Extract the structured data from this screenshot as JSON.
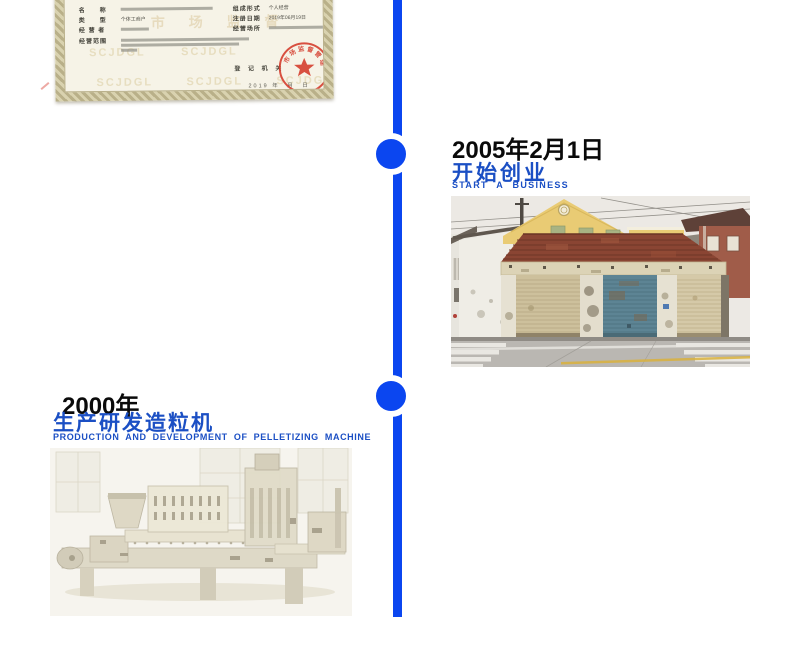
{
  "page": {
    "background": "#ffffff"
  },
  "colors": {
    "timeline_blue": "#0b46f0",
    "heading_blue": "#1b4fc4",
    "heading_black": "#0a0a0a",
    "stamp_red": "#d4392a",
    "cert_paper": "#f6f3e7",
    "cert_border": "#b9b089"
  },
  "timeline": {
    "node_count": 2
  },
  "certificate": {
    "fields": {
      "name_label": "名　　称",
      "type_label": "类　　型",
      "type_value": "个体工商户",
      "operator_label": "经 营 者",
      "scope_label": "经营范围",
      "form_label": "组成形式",
      "form_value": "个人经营",
      "regdate_label": "注册日期",
      "regdate_value": "2019年06月19日",
      "place_label": "经营场所"
    },
    "registry_label": "登 记 机 关",
    "date_line": "2019 年　月　日",
    "watermark": "SCJDGL",
    "watermark_cn": "市 场 监 督",
    "stamp_ring_text": "市场监督管理局"
  },
  "milestone_2005": {
    "date": "2005年2月1日",
    "title_zh": "开始创业",
    "title_en": "START A BUSINESS",
    "photo": "old single-storey garage building with three roller shutters"
  },
  "milestone_2000": {
    "date": "2000年",
    "title_zh": "生产研发造粒机",
    "title_en": "PRODUCTION AND DEVELOPMENT OF PELLETIZING MACHINE",
    "photo": "faded photo of pelletizing extruder machine"
  }
}
